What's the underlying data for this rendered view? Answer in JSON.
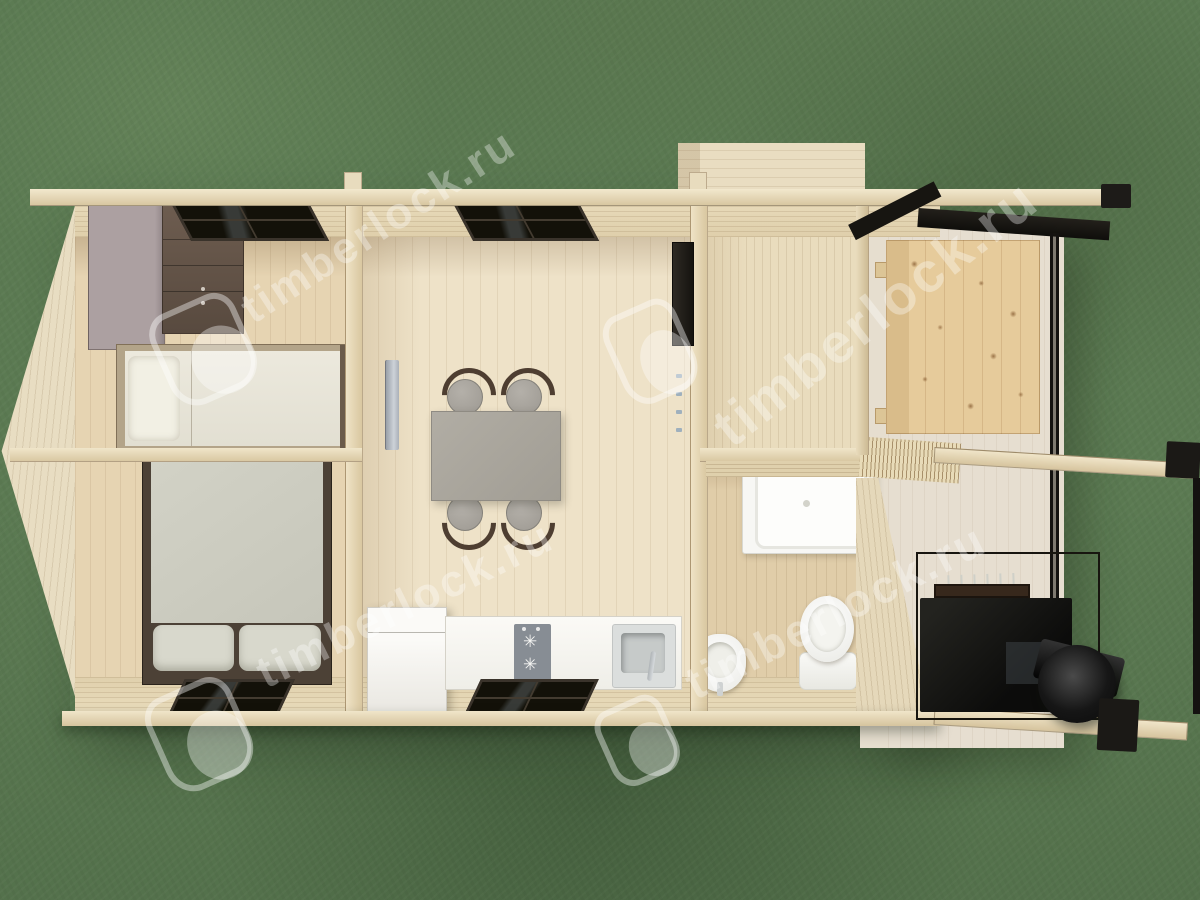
{
  "watermark": {
    "text": "timberlock.ru"
  },
  "scene": {
    "title": "log-cabin-floor-plan-top-view",
    "environment": "grass-lawn",
    "palette": {
      "grass": "#5b7a52",
      "floor_pine": "#ecdfc4",
      "wall_wood": "#e4d6b6",
      "beam_wood": "#eadfc4",
      "white_fixture": "#f6f5f1",
      "mattress_grey": "#cdcdc1",
      "wardrobe_grey": "#a89c9d",
      "dresser_brown": "#5e4f44",
      "black_metal": "#1b1916",
      "dining_table_grey": "#a9a59c",
      "terrace_pine": "#e6cb9b",
      "window_glass": "#131109"
    },
    "rooms": [
      {
        "name": "bedroom-top",
        "furniture": [
          "wardrobe",
          "dresser",
          "single-bed",
          "window"
        ]
      },
      {
        "name": "bedroom-bottom",
        "furniture": [
          "double-bed",
          "window"
        ]
      },
      {
        "name": "living-kitchen",
        "furniture": [
          "dining-table",
          "four-chairs",
          "radiator",
          "fridge",
          "kitchen-counter",
          "cooktop",
          "sink",
          "window-top",
          "window-bottom"
        ]
      },
      {
        "name": "hallway",
        "furniture": [
          "door"
        ]
      },
      {
        "name": "bathroom",
        "furniture": [
          "shower-tray",
          "toilet",
          "washbasin"
        ]
      },
      {
        "name": "terrace-pergola",
        "furniture": [
          "outdoor-table",
          "grill-stove",
          "chimney-cone",
          "pergola-beams"
        ]
      }
    ]
  }
}
